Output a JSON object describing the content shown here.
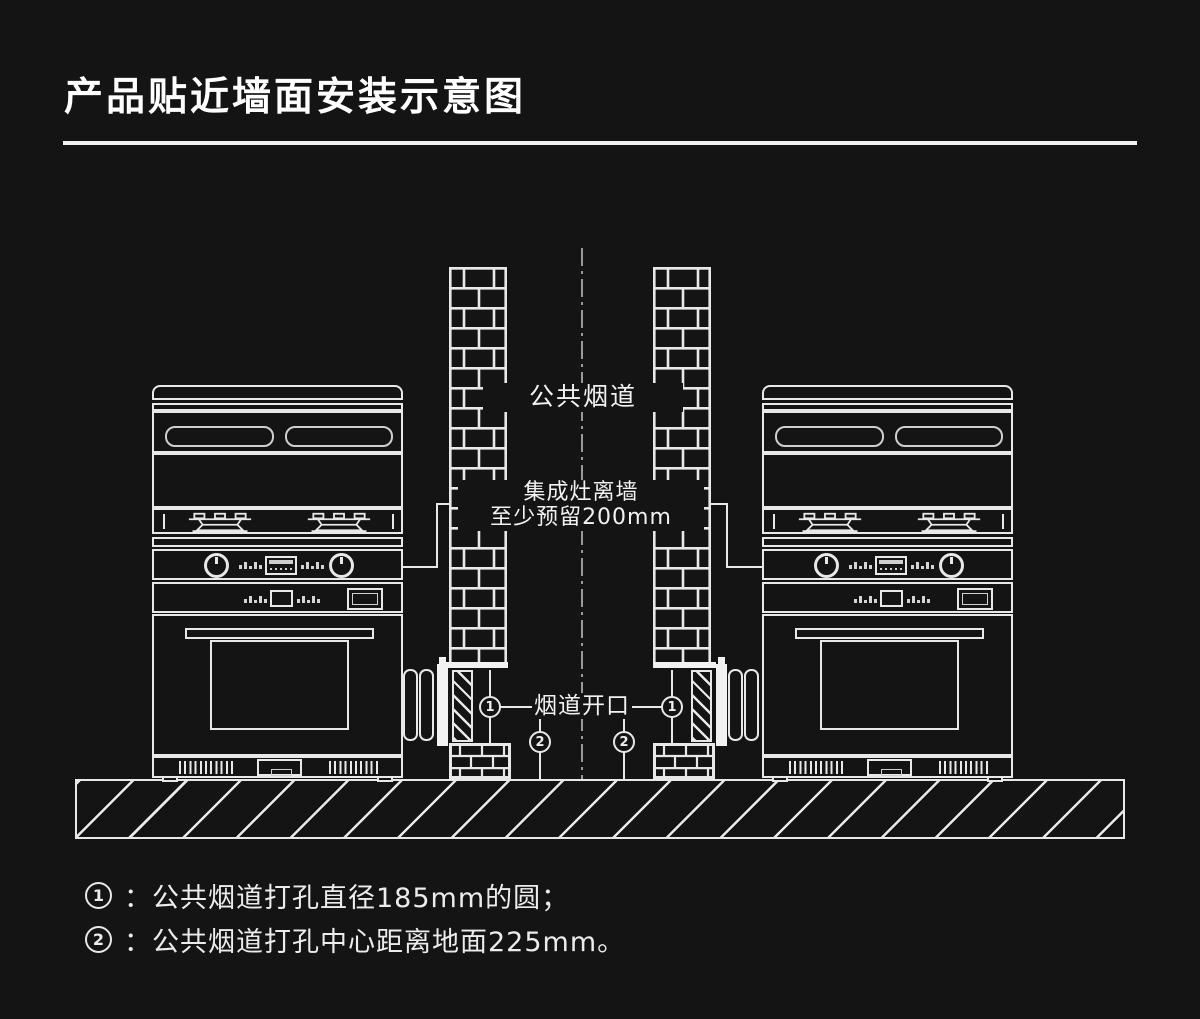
{
  "title": "产品贴近墙面安装示意图",
  "colors": {
    "background": "#141414",
    "line": "#e8e8e8",
    "centerline": "#9a9a9a"
  },
  "diagram": {
    "flue_label": "公共烟道",
    "clearance_label_line1": "集成灶离墙",
    "clearance_label_line2": "至少预留200mm",
    "opening_label": "烟道开口",
    "marker1": "1",
    "marker2": "2"
  },
  "notes": [
    {
      "marker": "1",
      "text": "：公共烟道打孔直径185mm的圆；"
    },
    {
      "marker": "2",
      "text": "：公共烟道打孔中心距离地面225mm。"
    }
  ]
}
